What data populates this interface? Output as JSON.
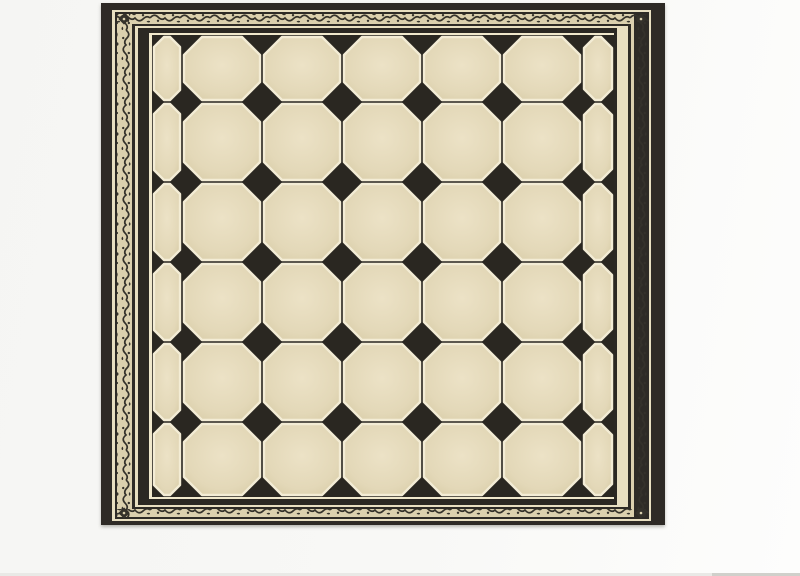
{
  "page": {
    "background_left": "#f5f5f3",
    "background_right": "#fdfdfc",
    "bottom_edge": {
      "y": 573,
      "height": 3,
      "track_color": "#e9e9e6",
      "thumb_x": 712,
      "thumb_width": 88,
      "thumb_color": "#d0d0cb"
    }
  },
  "artwork": {
    "pattern_name": "octagon-dot-tile-panel",
    "frame": {
      "x": 101,
      "y": 3,
      "width": 564,
      "height": 522,
      "colors": {
        "dark": "#2e2b26",
        "cream": "#e8dfc1",
        "ornament_bg": "#dbd0ae",
        "ornament_ink": "#35322b",
        "inner_dark": "#2b2823",
        "rim": "#f0e8cc"
      },
      "rings": [
        {
          "inset": [
            0,
            0,
            0,
            0
          ],
          "fill": "dark"
        },
        {
          "inset": [
            7,
            14,
            4,
            11
          ],
          "fill": "cream"
        },
        {
          "inset": [
            9,
            16,
            6,
            14
          ],
          "fill": "dark"
        },
        {
          "inset": [
            11,
            31,
            8,
            16
          ],
          "fill": "ornament_bg"
        },
        {
          "inset": [
            21,
            34,
            16,
            31
          ],
          "fill": "dark"
        },
        {
          "inset": [
            23,
            37,
            18,
            34
          ],
          "fill": "cream"
        },
        {
          "inset": [
            25,
            48,
            20,
            37
          ],
          "fill": "inner_dark"
        },
        {
          "inset": [
            30,
            51,
            26,
            48
          ],
          "fill": "rim"
        }
      ],
      "ornament": {
        "bands": [
          {
            "x": 117,
            "y": 14,
            "w": 532,
            "h": 10,
            "dir": "h"
          },
          {
            "x": 117,
            "y": 509,
            "w": 532,
            "h": 8,
            "dir": "h"
          },
          {
            "x": 117,
            "y": 14,
            "w": 15,
            "h": 503,
            "dir": "v"
          },
          {
            "x": 634,
            "y": 14,
            "w": 15,
            "h": 503,
            "dir": "v"
          }
        ],
        "corners": [
          [
            124,
            19
          ],
          [
            641,
            19
          ],
          [
            124,
            513
          ],
          [
            641,
            513
          ]
        ]
      }
    },
    "tiles": {
      "field": {
        "x": 152,
        "y": 35,
        "width": 462,
        "height": 462
      },
      "col_bounds": [
        0,
        30,
        110,
        190,
        270,
        350,
        430,
        462
      ],
      "row_bounds": [
        0,
        67,
        147,
        227,
        307,
        387,
        462
      ],
      "corner_cut": 18,
      "tile_inset": 2,
      "colors": {
        "grout_dark": "#2a2721",
        "tile_light": "#ece2c6",
        "tile_mid": "#e3d8b8",
        "tile_edge": "#d8cca7",
        "grout_cream": "#f3ecd5"
      }
    }
  }
}
